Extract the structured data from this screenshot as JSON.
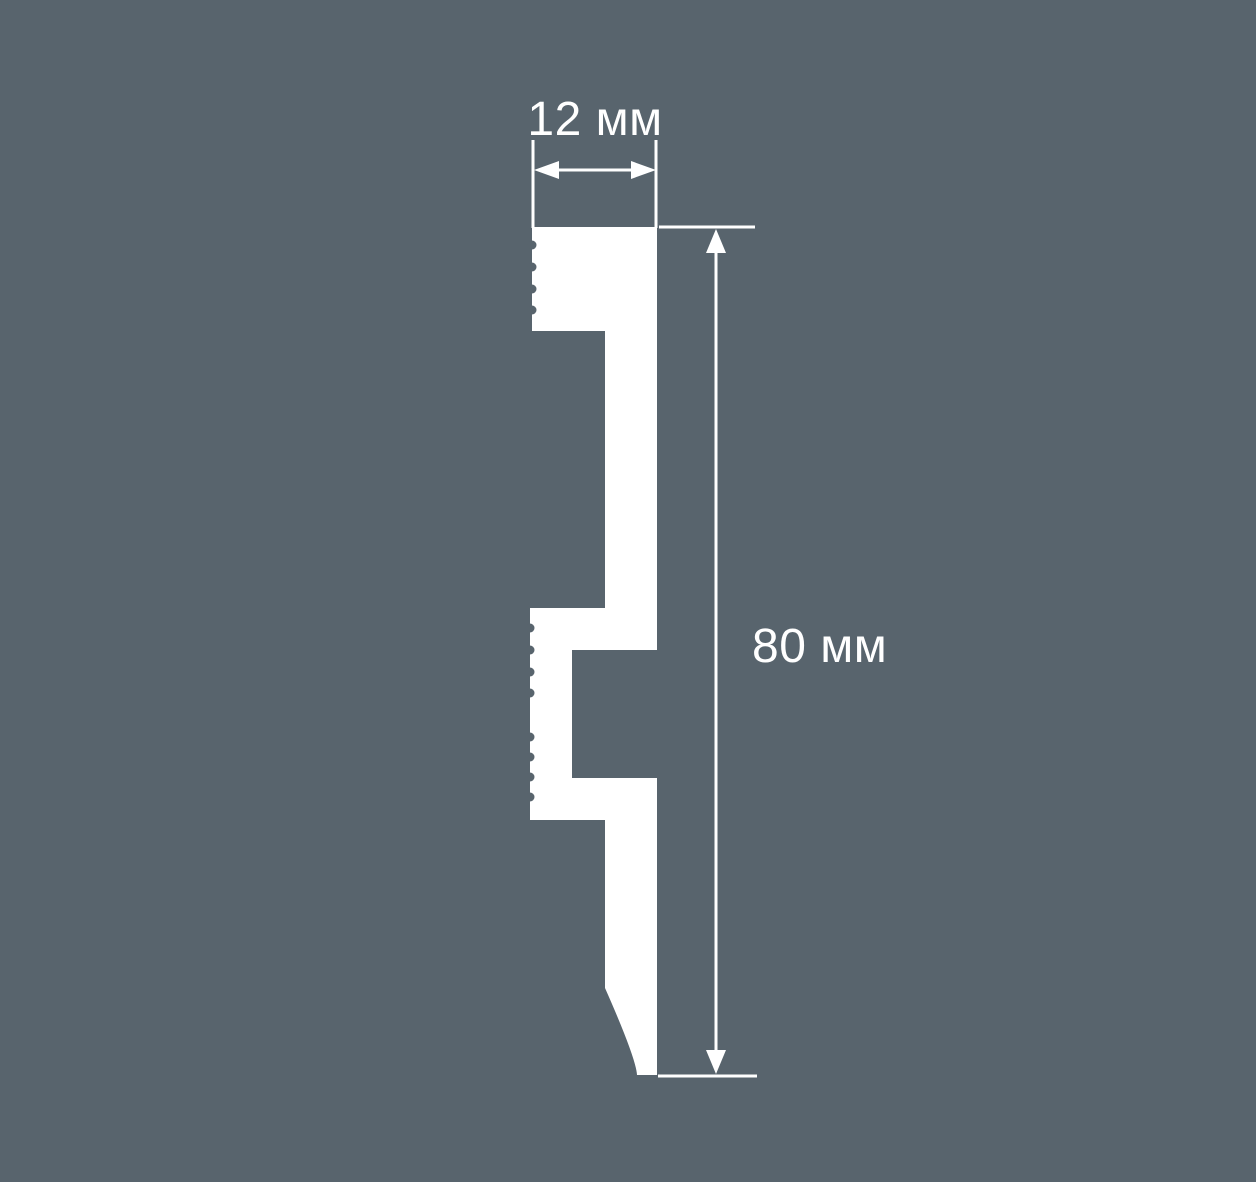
{
  "colors": {
    "background": "#58646D",
    "profile": "#FFFFFF"
  },
  "dimensions": {
    "width_label": "12 мм",
    "width_value_mm": 12,
    "height_label": "80 мм",
    "height_value_mm": 80
  }
}
